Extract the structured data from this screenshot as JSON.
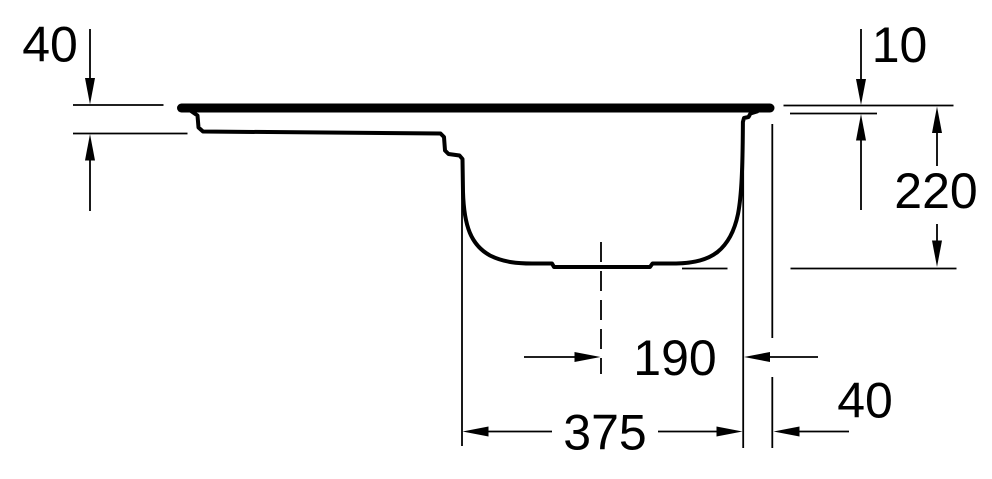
{
  "drawing": {
    "kind": "technical cross-section line drawing",
    "subject": "sink bowl side profile with drainboard",
    "background_color": "#ffffff",
    "ink_color": "#000000",
    "labels": {
      "top_left": "40",
      "top_right": "10",
      "right": "220",
      "center": "190",
      "bottom": "375",
      "bottom_right": "40"
    }
  }
}
